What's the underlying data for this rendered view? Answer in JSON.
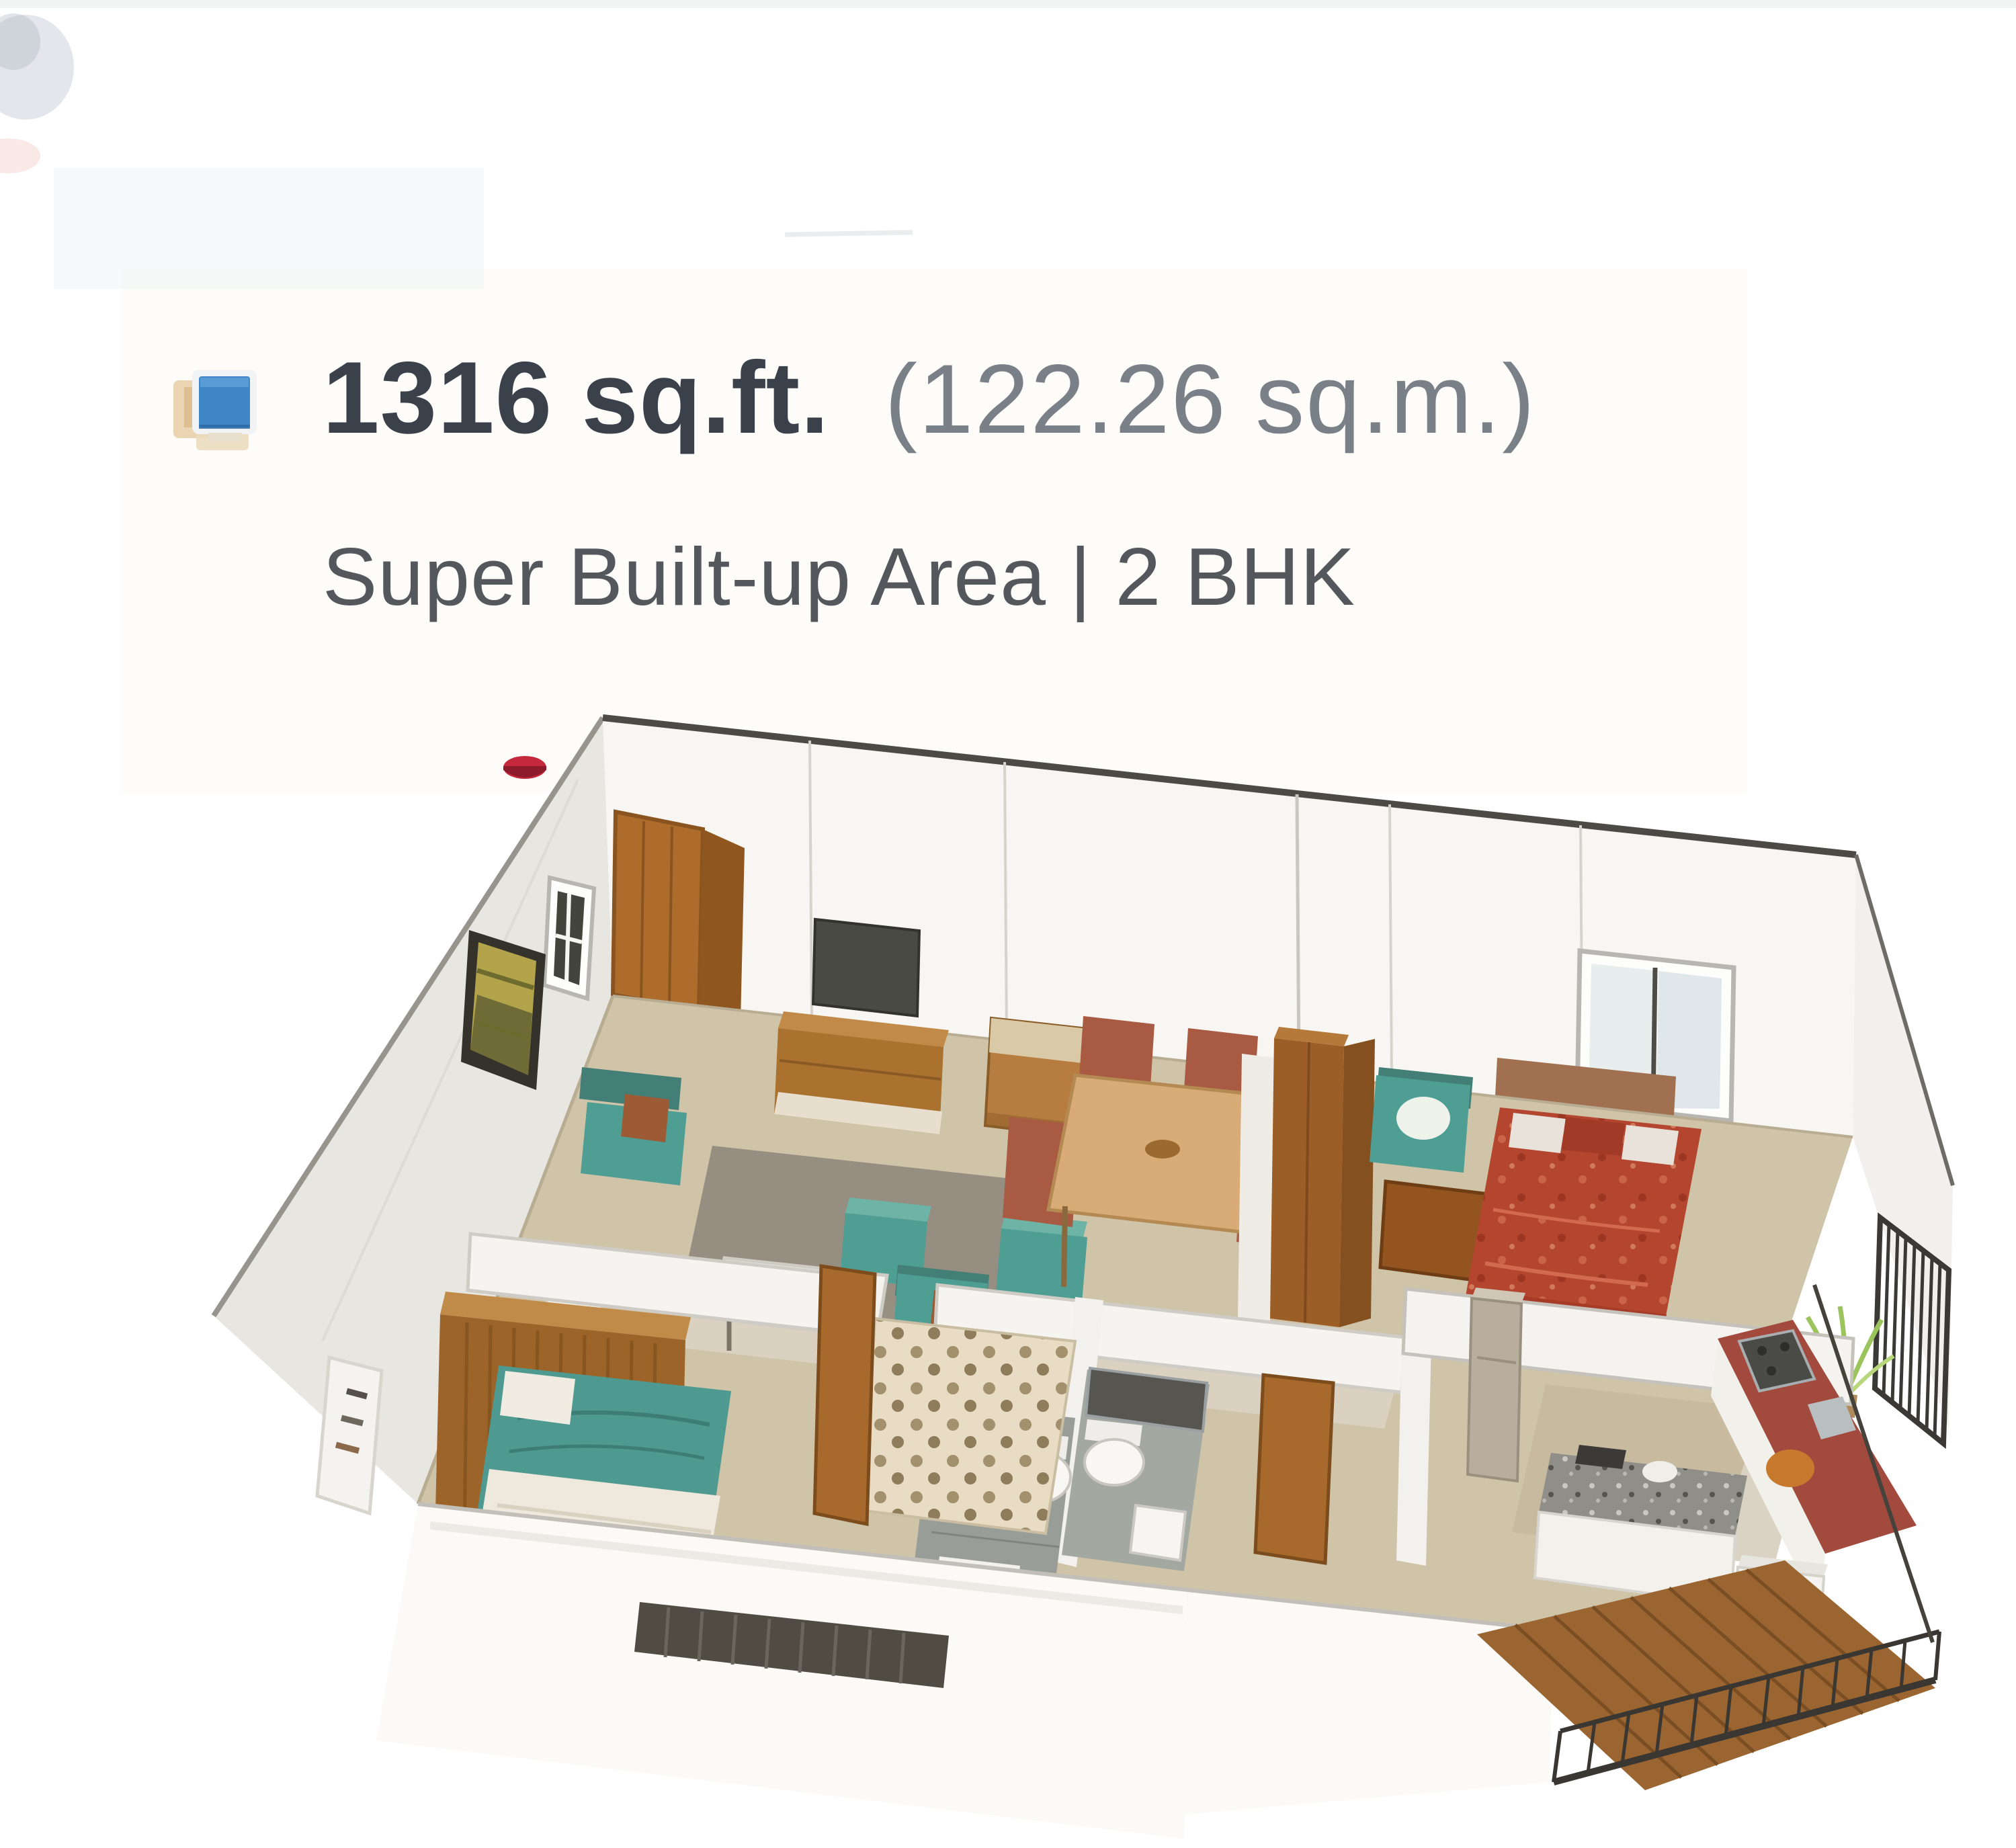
{
  "header": {
    "area_primary": "1316 sq.ft.",
    "area_secondary": "(122.26 sq.m.)",
    "subtitle": "Super Built-up Area | 2 BHK"
  },
  "colors": {
    "title": "#3a414b",
    "title_secondary": "#7a8088",
    "subtitle": "#54585d",
    "icon_blue": "#3e86c6",
    "floor_beige": "#cfc3a8",
    "wall_white": "#f6f5f2",
    "wood_brown": "#a96e2f",
    "teal_furniture": "#4f9e94",
    "master_bed_red": "#b4452f",
    "kitchen_counter_red": "#a34a3e",
    "railing_dark": "#3a3733",
    "plant_green": "#9cc45c"
  },
  "floorplan": {
    "label": "3D isometric floor plan - 2 BHK"
  }
}
